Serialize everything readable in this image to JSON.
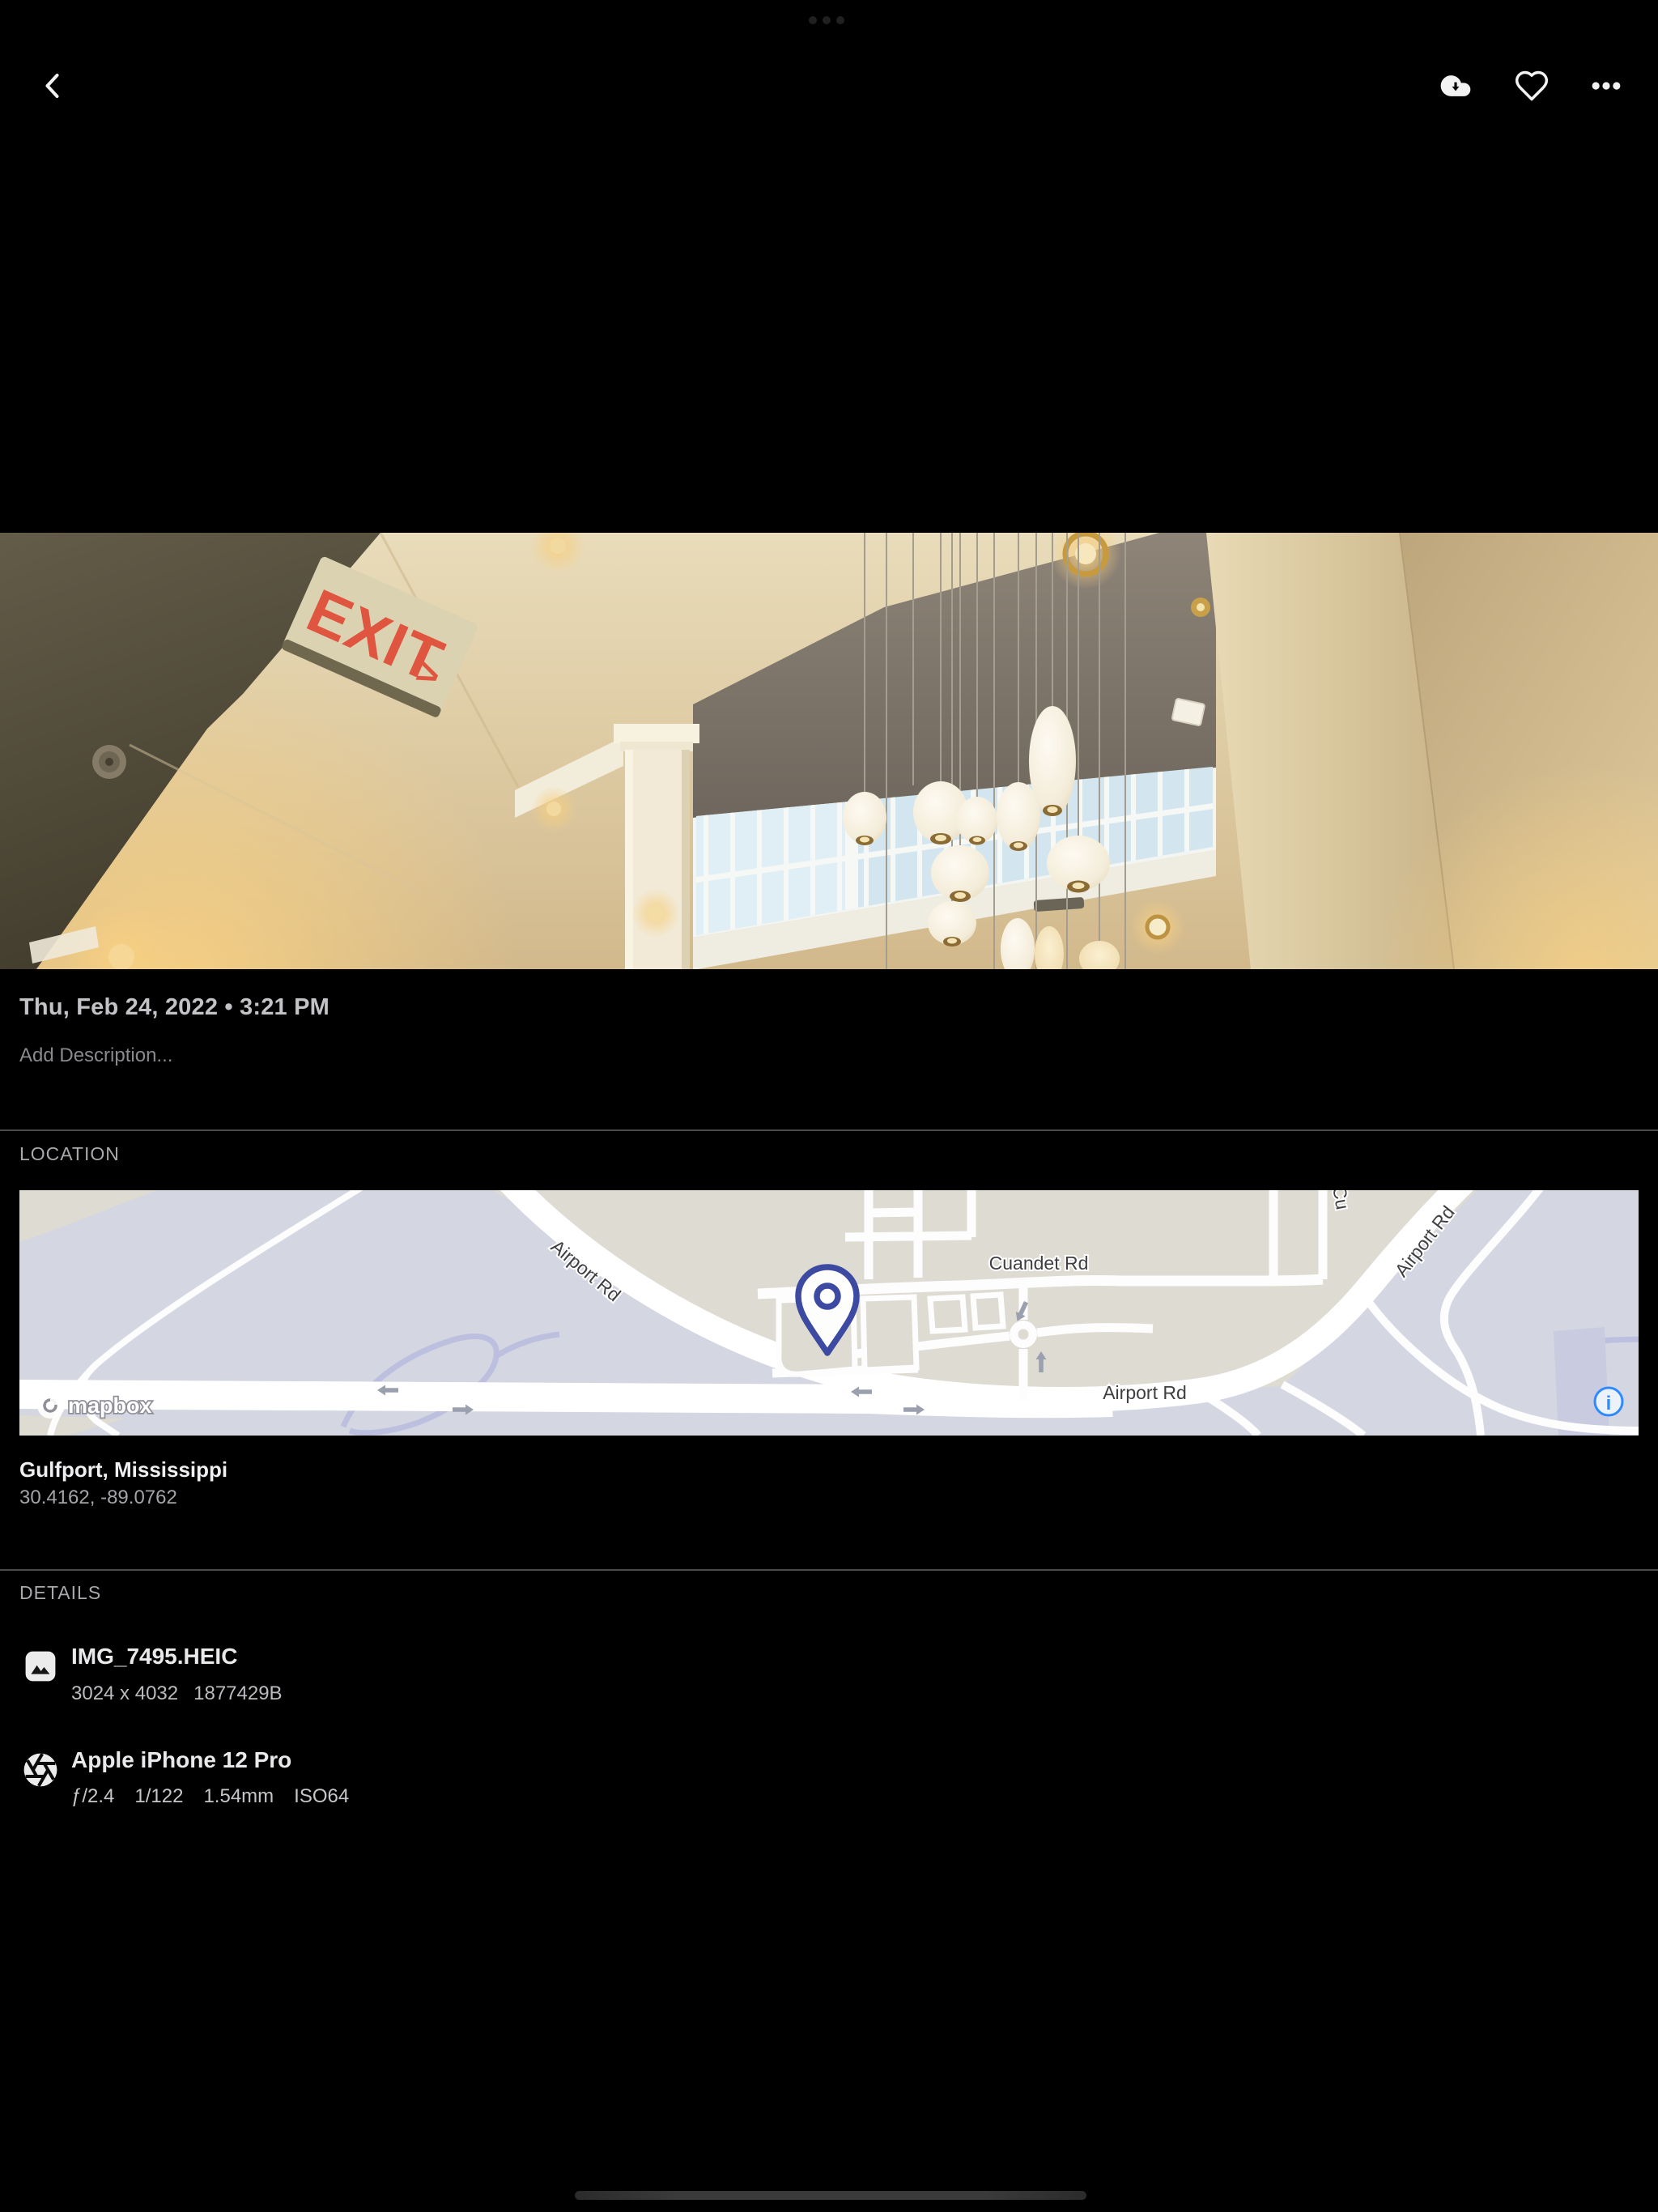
{
  "app": {
    "background": "#000000",
    "accent_blue": "#2e8bff"
  },
  "top_bar": {
    "back_icon": "chevron-left",
    "download_icon": "cloud-download",
    "favorite_icon": "heart-outline",
    "more_icon": "ellipsis-horizontal"
  },
  "photo": {
    "scene": "hotel-atrium-ceiling-with-pendant-lamps",
    "exit_sign_text": "EXIT",
    "exit_sign_arrow": ">"
  },
  "info": {
    "date": "Thu, Feb 24, 2022 • 3:21 PM",
    "description_placeholder": "Add Description..."
  },
  "location": {
    "header": "LOCATION",
    "place": "Gulfport, Mississippi",
    "coordinates": "30.4162, -89.0762",
    "map": {
      "labels": {
        "airport_rd_diagonal": "Airport Rd",
        "airport_rd_horizontal": "Airport Rd",
        "airport_rd_topright": "Airport Rd",
        "cuandet_rd": "Cuandet Rd",
        "cu_partial": "Cu"
      },
      "attribution": "mapbox",
      "info_glyph": "i",
      "pin_color": "#3d4aa1",
      "colors": {
        "land": "#d4d6e2",
        "built": "#dedbd3",
        "road": "#ffffff",
        "secondary_road": "#bdbfdf"
      }
    }
  },
  "details": {
    "header": "DETAILS",
    "file": {
      "icon": "image-file",
      "name": "IMG_7495.HEIC",
      "dimensions": "3024 x 4032",
      "size": "1877429B"
    },
    "camera": {
      "icon": "aperture",
      "name": "Apple iPhone 12 Pro",
      "specs": [
        "ƒ/2.4",
        "1/122",
        "1.54mm",
        "ISO64"
      ]
    }
  }
}
